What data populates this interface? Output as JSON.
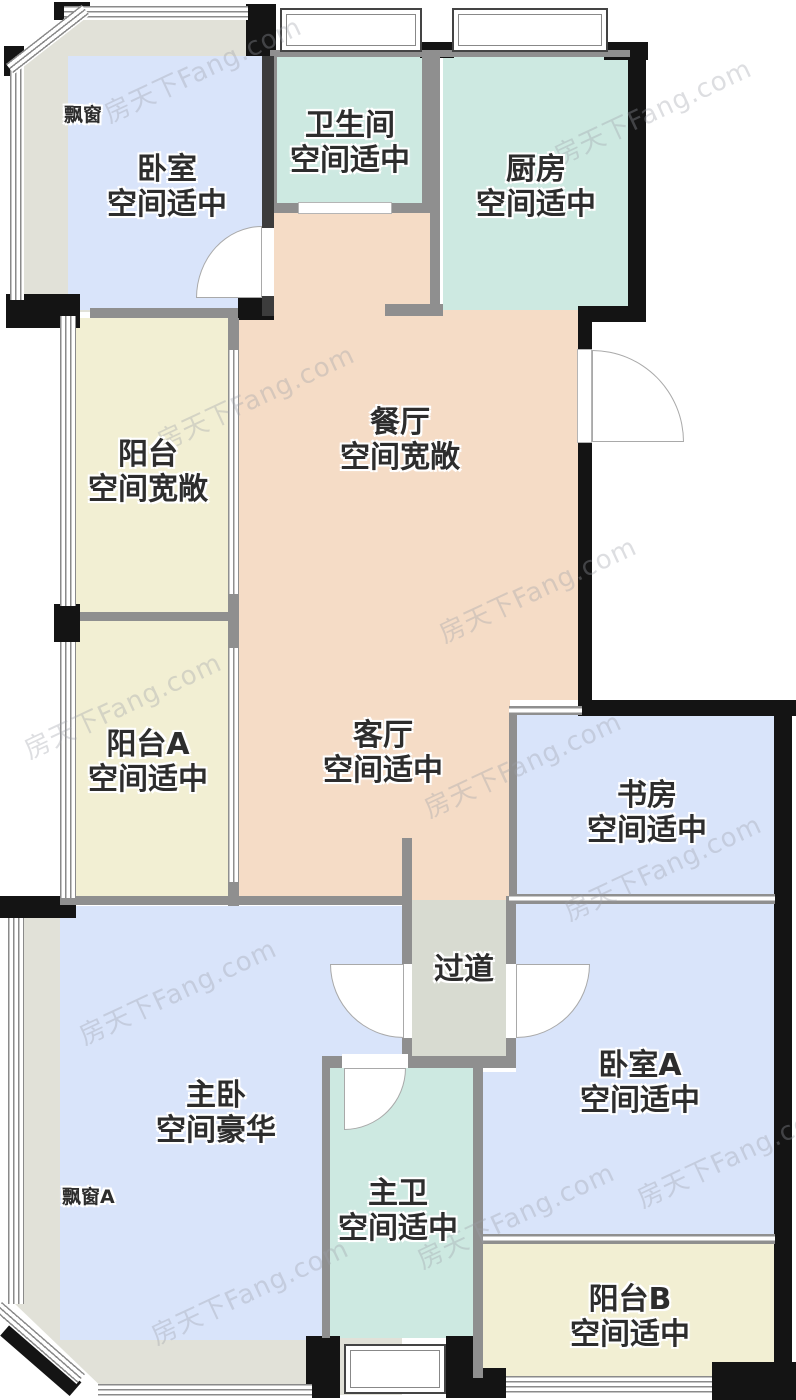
{
  "watermark": {
    "text": "房天下Fang.com"
  },
  "colors": {
    "room_blue": "#d9e4fa",
    "room_teal": "#cde9e1",
    "room_peach": "#f5dcc6",
    "room_yellow": "#f2efd3",
    "hallway_gray": "#d8dbd1",
    "bay_band": "#e1e1d8",
    "wall_black": "#141414",
    "wall_gray": "#8f8f8f"
  },
  "rooms": {
    "bedroom": {
      "name": "卧室",
      "note": "空间适中"
    },
    "bathroom": {
      "name": "卫生间",
      "note": "空间适中"
    },
    "kitchen": {
      "name": "厨房",
      "note": "空间适中"
    },
    "dining": {
      "name": "餐厅",
      "note": "空间宽敞"
    },
    "balcony": {
      "name": "阳台",
      "note": "空间宽敞"
    },
    "balcony_a": {
      "name": "阳台A",
      "note": "空间适中"
    },
    "living": {
      "name": "客厅",
      "note": "空间适中"
    },
    "study": {
      "name": "书房",
      "note": "空间适中"
    },
    "hallway": {
      "name": "过道"
    },
    "master_bedroom": {
      "name": "主卧",
      "note": "空间豪华"
    },
    "bedroom_a": {
      "name": "卧室A",
      "note": "空间适中"
    },
    "master_bath": {
      "name": "主卫",
      "note": "空间适中"
    },
    "balcony_b": {
      "name": "阳台B",
      "note": "空间适中"
    },
    "bay_window": {
      "name": "飘窗"
    },
    "bay_window_a": {
      "name": "飘窗A"
    }
  }
}
